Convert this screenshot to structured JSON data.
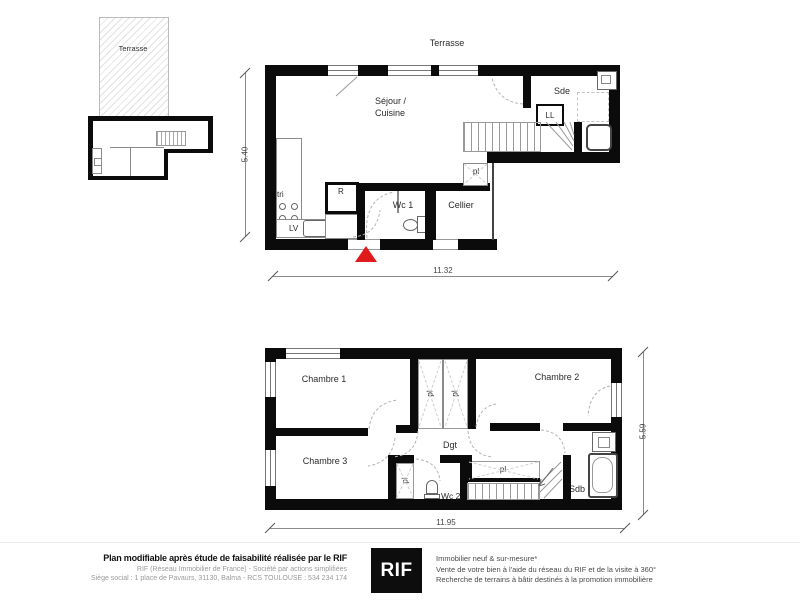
{
  "colors": {
    "wall": "#0b0b0b",
    "accent_red": "#e11b1b",
    "logo_bg": "#0d0d0d",
    "line_gray": "#8a8a8a"
  },
  "mini_plan": {
    "terrace_label": "Terrasse"
  },
  "ground_floor": {
    "terrace_label": "Terrasse",
    "room_sejour_line1": "Séjour /",
    "room_sejour_line2": "Cuisine",
    "room_sde": "Sde",
    "room_wc1": "Wc 1",
    "room_cellier": "Cellier",
    "label_ll": "LL",
    "label_pl": "pl",
    "label_tri": "tri",
    "label_r": "R",
    "label_lv": "LV",
    "dim_width_m": "11.32",
    "dim_height_m": "5.40"
  },
  "first_floor": {
    "room_chambre1": "Chambre 1",
    "room_chambre2": "Chambre 2",
    "room_chambre3": "Chambre 3",
    "room_dgt": "Dgt",
    "room_wc2": "Wc 2",
    "room_sdb": "Sdb",
    "label_pl": "pl",
    "dim_width_m": "11.95",
    "dim_height_m": "5.59"
  },
  "footer": {
    "disclaimer": "Plan modifiable après étude de faisabilité réalisée par le RIF",
    "company_line1": "RIF (Réseau Immobilier de France) - Société par actions simplifiées",
    "company_line2": "Siège social : 1 place de Pavaurs, 31130, Balma - RCS TOULOUSE : 534 234 174",
    "logo_text": "RIF",
    "tagline_line1": "Immobilier neuf & sur-mesure*",
    "tagline_line2": "Vente de votre bien à l'aide du réseau du RIF et de la visite à 360°",
    "tagline_line3": "Recherche de terrains à bâtir destinés à la promotion immobilière"
  }
}
